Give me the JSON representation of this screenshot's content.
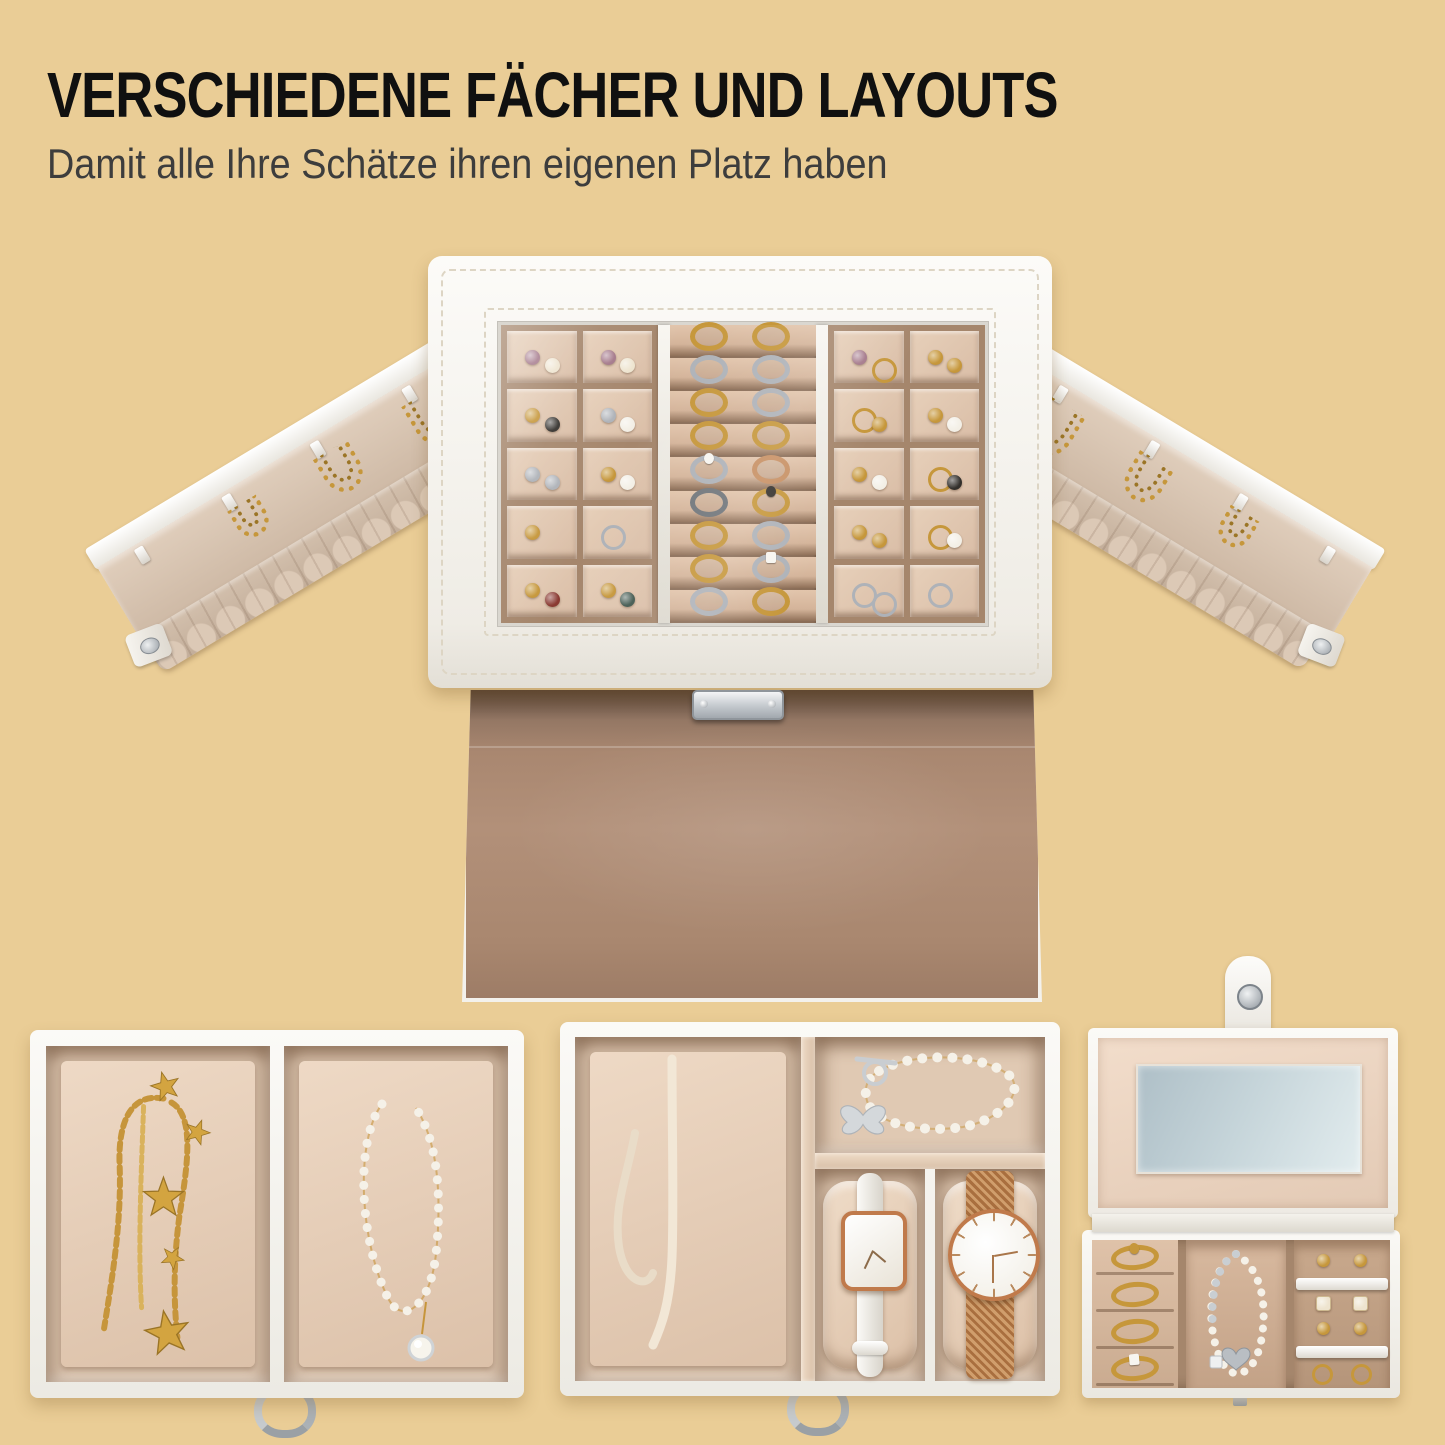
{
  "header": {
    "title": "VERSCHIEDENE FÄCHER UND LAYOUTS",
    "subtitle": "Damit alle Ihre Schätze ihren eigenen Platz haben"
  },
  "palette": {
    "background": "#eacd96",
    "leatherWhite": "#f8f7f3",
    "leatherShade": "#e7e4dc",
    "stitch": "#ddd5c4",
    "velvetCell": "#d9bda6",
    "velvetCellLight": "#e7d0ba",
    "velvetWall": "#a5866c",
    "velvetDeep": "#8a6d57",
    "velvetPanel": "#ab8971",
    "velvetTray": "#e0c9b3",
    "cushion": "#eed9c5",
    "gold": "#c6973b",
    "goldDeep": "#9b7526",
    "silver": "#b4b8bd",
    "silverDeep": "#8e939a",
    "roseGold": "#c07a4b",
    "pearl": "#f4f0e7",
    "mirrorA": "#aebfc7",
    "mirrorB": "#e2ecee",
    "titleColor": "#101010",
    "subtitleColor": "#3d3d3d"
  },
  "jewelTones": {
    "plum": "#a4788a",
    "cream": "#eee4cf",
    "gold": "#c6973b",
    "silver": "#aeb2b8",
    "pearl": "#f3efe6",
    "black": "#33302c",
    "red": "#8a3a32",
    "teal": "#41584f",
    "rose": "#c78f62",
    "dark": "#70757a",
    "white": "#f7f5f0"
  },
  "top_box": {
    "left_grid": [
      [
        "plum",
        "cream"
      ],
      [
        "plum",
        "cream"
      ],
      [
        "gold",
        "black"
      ],
      [
        "silver",
        "pearl"
      ],
      [
        "silver",
        "silver"
      ],
      [
        "gold",
        "pearl"
      ],
      [
        "gold"
      ],
      [
        "o:silver"
      ],
      [
        "gold",
        "red"
      ],
      [
        "gold",
        "teal"
      ]
    ],
    "right_grid": [
      [
        "plum",
        "o:gold"
      ],
      [
        "gold",
        "gold"
      ],
      [
        "o:gold",
        "gold"
      ],
      [
        "gold",
        "pearl"
      ],
      [
        "gold",
        "pearl"
      ],
      [
        "o:gold",
        "black"
      ],
      [
        "gold",
        "gold"
      ],
      [
        "o:gold",
        "pearl"
      ],
      [
        "o:silver",
        "o:silver"
      ],
      [
        "o:silver"
      ]
    ],
    "ring_rows": [
      [
        "gold",
        "gold"
      ],
      [
        "silver",
        "silver"
      ],
      [
        "gold",
        "silver"
      ],
      [
        "gold",
        "gold"
      ],
      [
        "silver+white",
        "rose"
      ],
      [
        "dark",
        "gold+black"
      ],
      [
        "gold",
        "silver"
      ],
      [
        "gold",
        "silver+whiteSq"
      ],
      [
        "silver",
        "gold"
      ]
    ]
  },
  "wings": {
    "left": [
      {
        "p": 0.1,
        "kind": "hook"
      },
      {
        "p": 0.33,
        "kind": "chain",
        "s": 24
      },
      {
        "p": 0.56,
        "kind": "chain",
        "s": 30
      },
      {
        "p": 0.8,
        "kind": "chain",
        "s": 38
      }
    ],
    "right": [
      {
        "p": 0.2,
        "kind": "chain",
        "s": 38
      },
      {
        "p": 0.44,
        "kind": "chain",
        "s": 30
      },
      {
        "p": 0.67,
        "kind": "chain",
        "s": 24
      },
      {
        "p": 0.9,
        "kind": "hook"
      }
    ]
  },
  "case": {
    "rings": [
      "gold+gold",
      "gold",
      "gold",
      "gold+whiteSq"
    ],
    "stud_rows": [
      {
        "yAbove": 14,
        "yBar": 38,
        "yBelow": 56,
        "above": [
          "gold",
          "gold"
        ],
        "below": [
          "sq:cream",
          "sq:cream"
        ]
      },
      {
        "yAbove": 82,
        "yBar": 106,
        "yBelow": 124,
        "above": [
          "gold",
          "gold"
        ],
        "below": [
          "o:gold",
          "o:gold"
        ]
      }
    ]
  }
}
